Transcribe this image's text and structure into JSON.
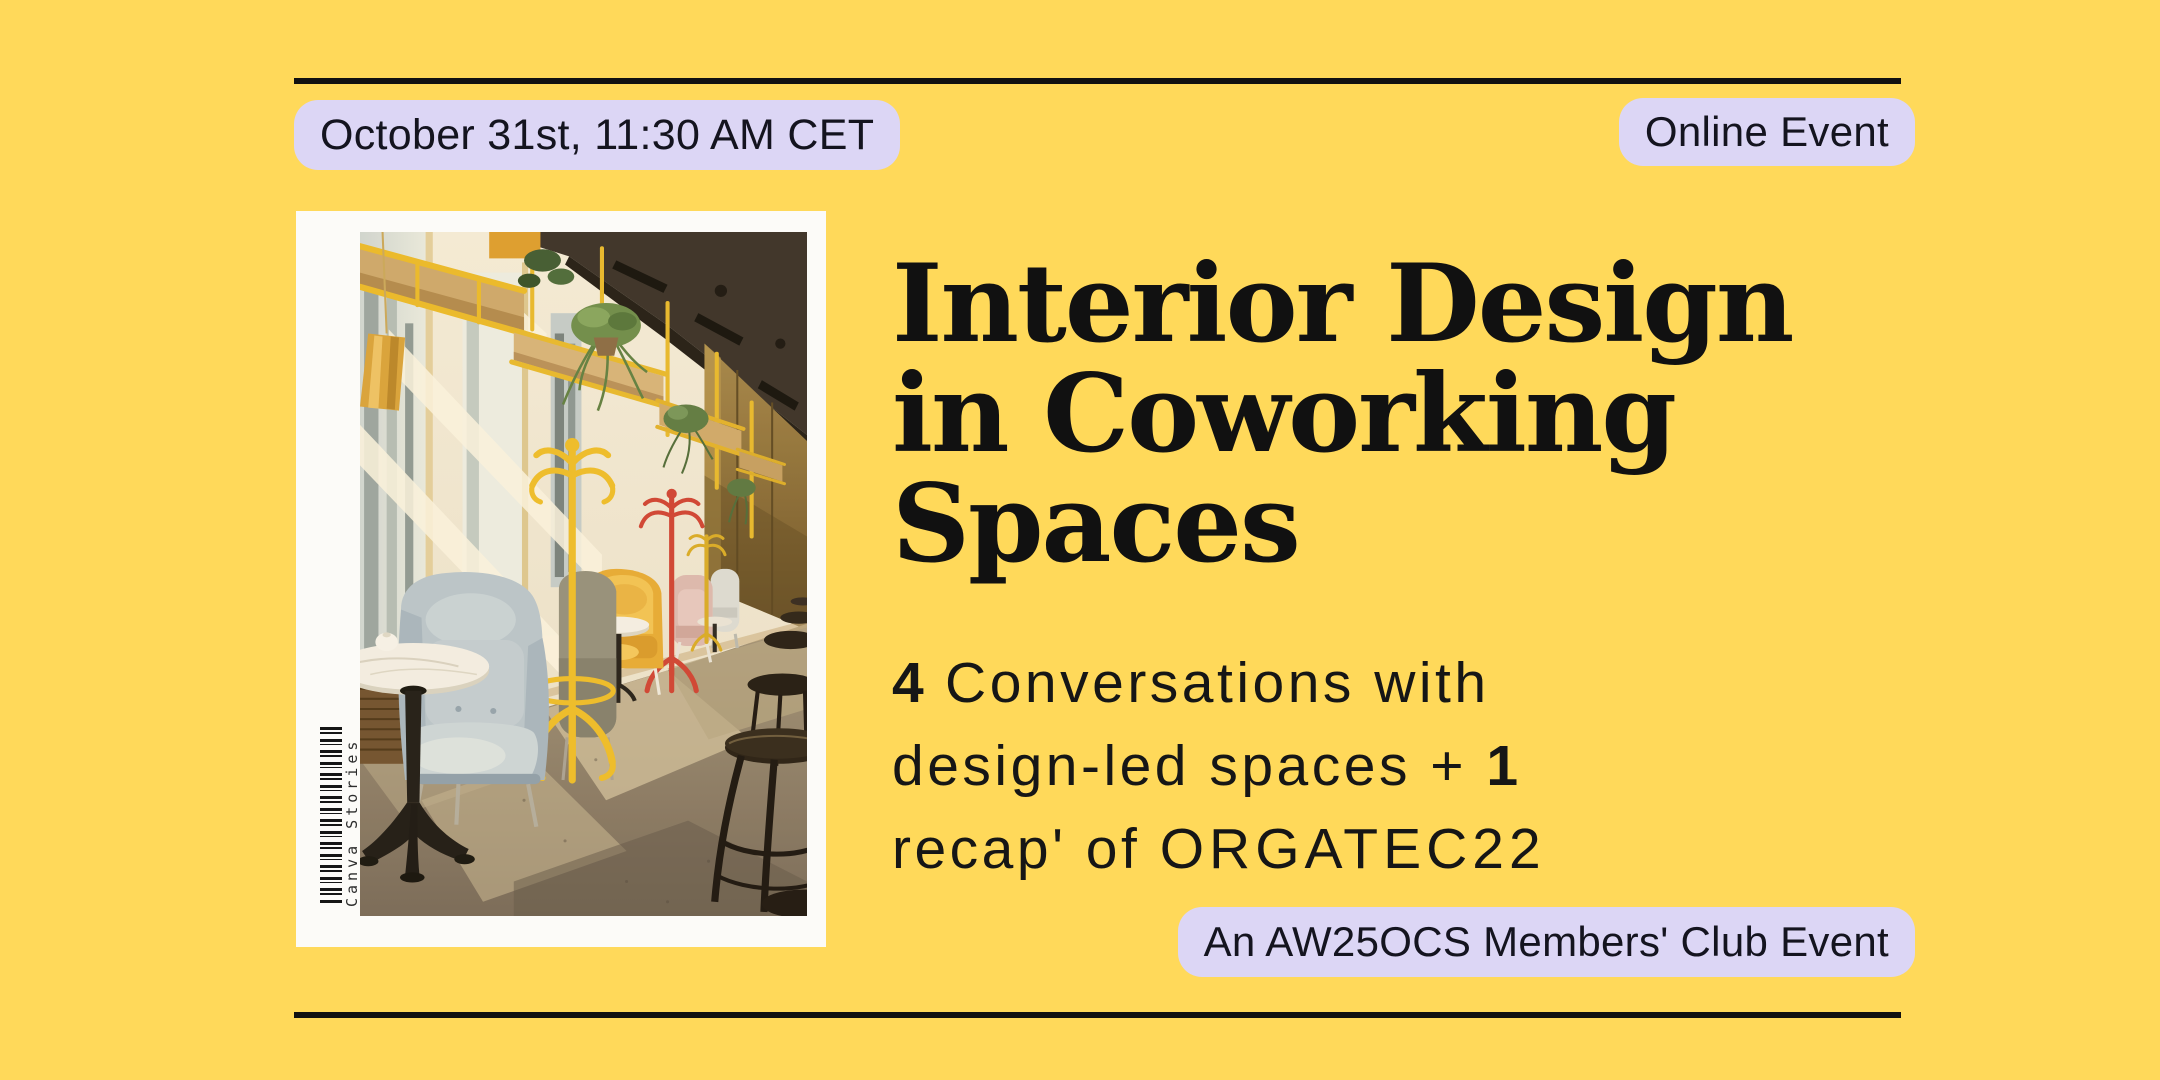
{
  "banner": {
    "background_color": "#ffd95a",
    "badge_color": "#dcd6f5",
    "badge_text_color": "#14141f",
    "text_color": "#111111",
    "rule_color": "#111111",
    "underline_color": "#c6bfea"
  },
  "header": {
    "date_badge_label": "October 31st, 11:30 AM CET",
    "event_type_badge_label": "Online Event"
  },
  "title": {
    "lines": [
      "Interior Design",
      "in Coworking",
      "Spaces"
    ]
  },
  "subtitle": {
    "count_conversations": "4",
    "line1_text": "Conversations with",
    "line2_text": "design-led spaces +",
    "count_recap": "1",
    "line3_text": "recap' of",
    "line3_underlined": "ORGATEC22"
  },
  "footer": {
    "club_badge_label": "An AW25OCS Members' Club Event"
  },
  "photo": {
    "caption_vertical": "Canva Stories",
    "description": "Sunlit coworking cafe interior with pastel wing armchairs, yellow coat stands, hanging plants, a marble bistro table and dark bentwood stools"
  }
}
